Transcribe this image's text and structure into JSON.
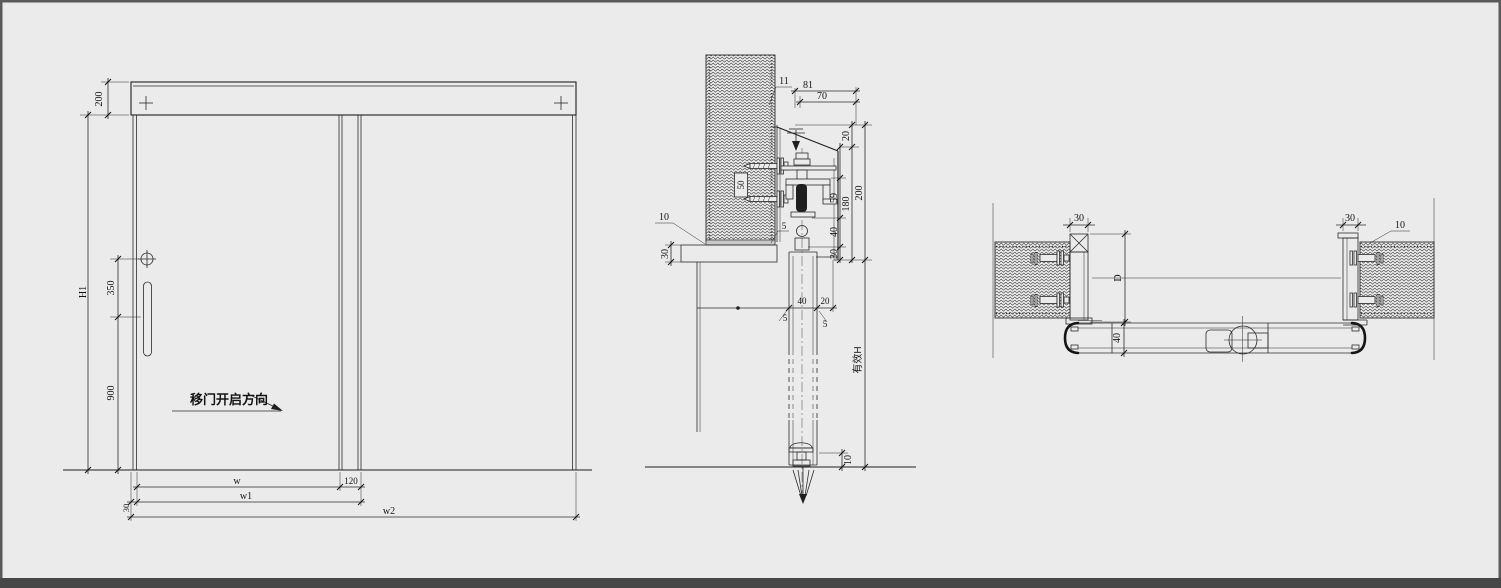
{
  "meta": {
    "background_color": "#ebebeb",
    "line_color": "#2b2b2b",
    "frame_color": "#474747",
    "drawing_type": "sliding-door shop drawing, elevation + vertical section + plan section"
  },
  "elevation": {
    "header_height": "200",
    "door_height": "H1",
    "handle_offset": "350",
    "handle_height": "900",
    "width_w": "w",
    "overlap_120": "120",
    "edge_30": "30",
    "width_w1": "w1",
    "width_w2": "w2",
    "open_direction": "移门开启方向"
  },
  "section": {
    "lip_11": "11",
    "track_81": "81",
    "track_70": "70",
    "gap_20_top": "20",
    "roller_59": "59",
    "height_180": "180",
    "height_200": "200",
    "seg_40": "40",
    "seg_30": "30",
    "wall_50": "50",
    "gap_10_wall": "10",
    "board_30": "30",
    "door_40": "40",
    "gap_20_door": "20",
    "clear_5a": "5",
    "clear_5b": "5",
    "clear_5c": "5",
    "effective_h": "有效H",
    "floor_10": "10"
  },
  "plan": {
    "post_30_left": "30",
    "post_30_right": "30",
    "gap_10": "10",
    "depth_D": "D",
    "door_40": "40"
  }
}
